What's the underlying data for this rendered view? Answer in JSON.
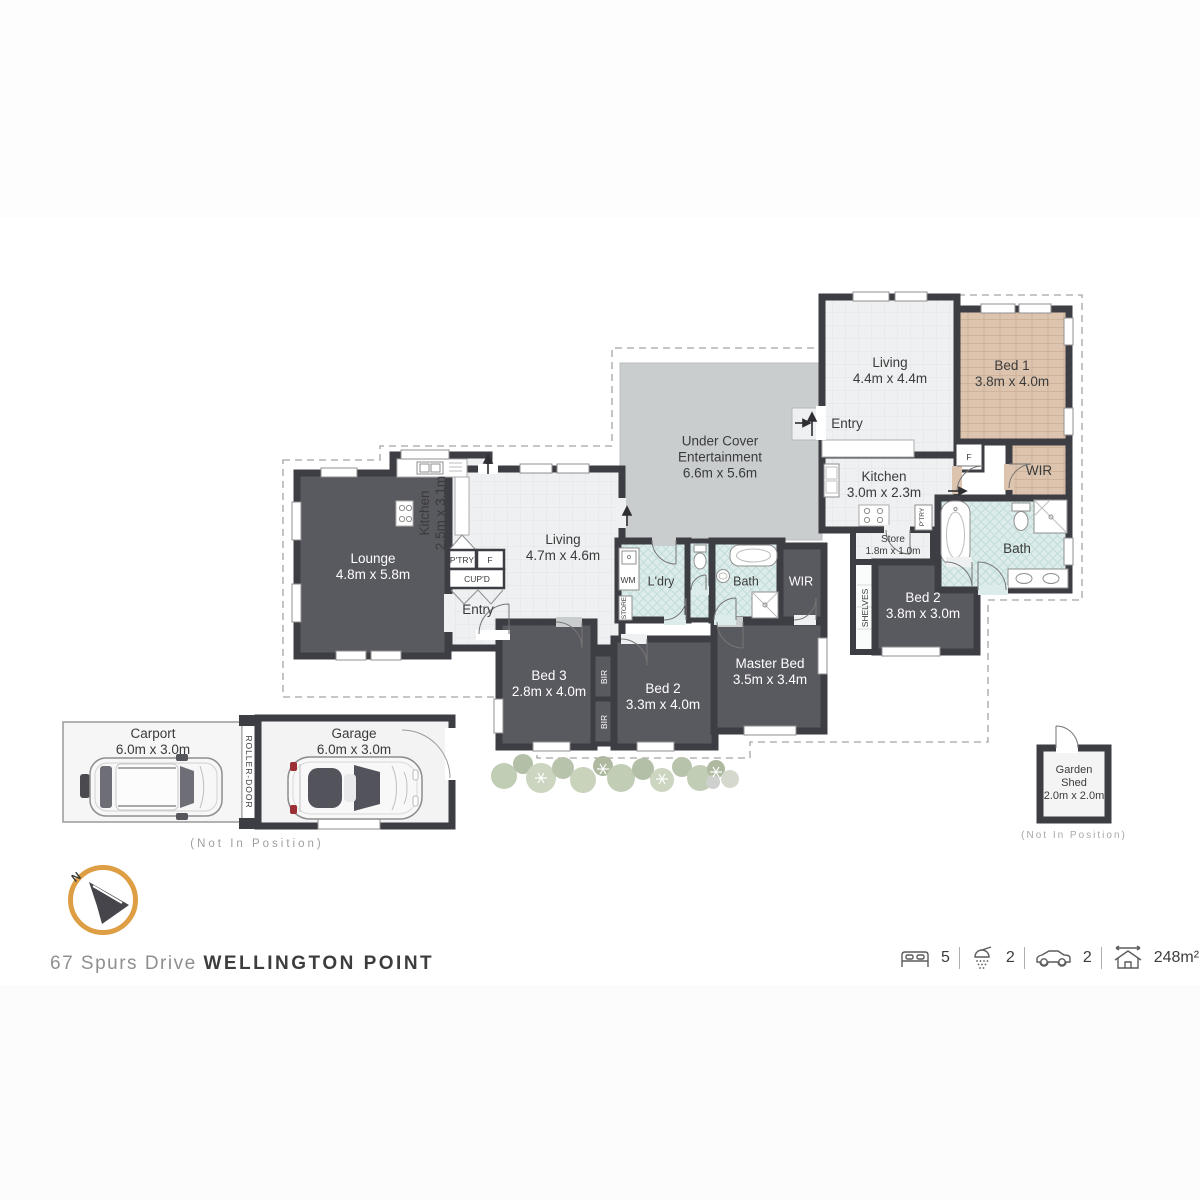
{
  "meta": {
    "address_street": "67 Spurs Drive",
    "address_suburb": "WELLINGTON POINT",
    "not_in_position": "(Not In Position)",
    "compass_n": "N"
  },
  "stats": {
    "beds": "5",
    "baths": "2",
    "cars": "2",
    "area": "248m²"
  },
  "colors": {
    "wall": "#3d3d44",
    "dark_room": "#595960",
    "light_floor": "#eef0f1",
    "patio": "#c9cdce",
    "wood_floor": "#dcc4ae",
    "tile_floor": "#dcecea",
    "compass_ring": "#dd9e44"
  },
  "rooms": {
    "lounge": {
      "label": "Lounge",
      "dims": "4.8m x 5.8m"
    },
    "kitchen1": {
      "label": "Kitchen",
      "dims": "2.5m x 3.1m"
    },
    "living1": {
      "label": "Living",
      "dims": "4.7m x 4.6m"
    },
    "entry1": {
      "label": "Entry"
    },
    "ptry1": {
      "label": "P'TRY"
    },
    "fridge1": {
      "label": "F"
    },
    "cupd": {
      "label": "CUP'D"
    },
    "wm": {
      "label": "WM"
    },
    "store_mini": {
      "label": "STORE"
    },
    "ldry": {
      "label": "L'dry"
    },
    "bath1": {
      "label": "Bath"
    },
    "wir1": {
      "label": "WIR"
    },
    "bed3": {
      "label": "Bed 3",
      "dims": "2.8m x 4.0m"
    },
    "bir_top": {
      "label": "BIR"
    },
    "bir_bottom": {
      "label": "BIR"
    },
    "bed2_main": {
      "label": "Bed 2",
      "dims": "3.3m x 4.0m"
    },
    "master": {
      "label": "Master Bed",
      "dims": "3.5m x 3.4m"
    },
    "under_cover": {
      "label": "Under Cover Entertainment",
      "dims": "6.6m x 5.6m"
    },
    "living2": {
      "label": "Living",
      "dims": "4.4m x 4.4m"
    },
    "bed1": {
      "label": "Bed 1",
      "dims": "3.8m x 4.0m"
    },
    "entry2": {
      "label": "Entry"
    },
    "kitchen2": {
      "label": "Kitchen",
      "dims": "3.0m x 2.3m"
    },
    "fridge2": {
      "label": "F"
    },
    "ptry2": {
      "label": "P'TRY"
    },
    "store2": {
      "label": "Store",
      "dims": "1.8m x 1.0m"
    },
    "shelves": {
      "label": "SHELVES"
    },
    "bed2_flat": {
      "label": "Bed 2",
      "dims": "3.8m x 3.0m"
    },
    "bath2": {
      "label": "Bath"
    },
    "wir2": {
      "label": "WIR"
    },
    "carport": {
      "label": "Carport",
      "dims": "6.0m x 3.0m"
    },
    "roller_door": {
      "label": "ROLLER-DOOR"
    },
    "garage": {
      "label": "Garage",
      "dims": "6.0m x 3.0m"
    },
    "shed": {
      "label": "Garden Shed",
      "dims": "2.0m x 2.0m"
    }
  }
}
